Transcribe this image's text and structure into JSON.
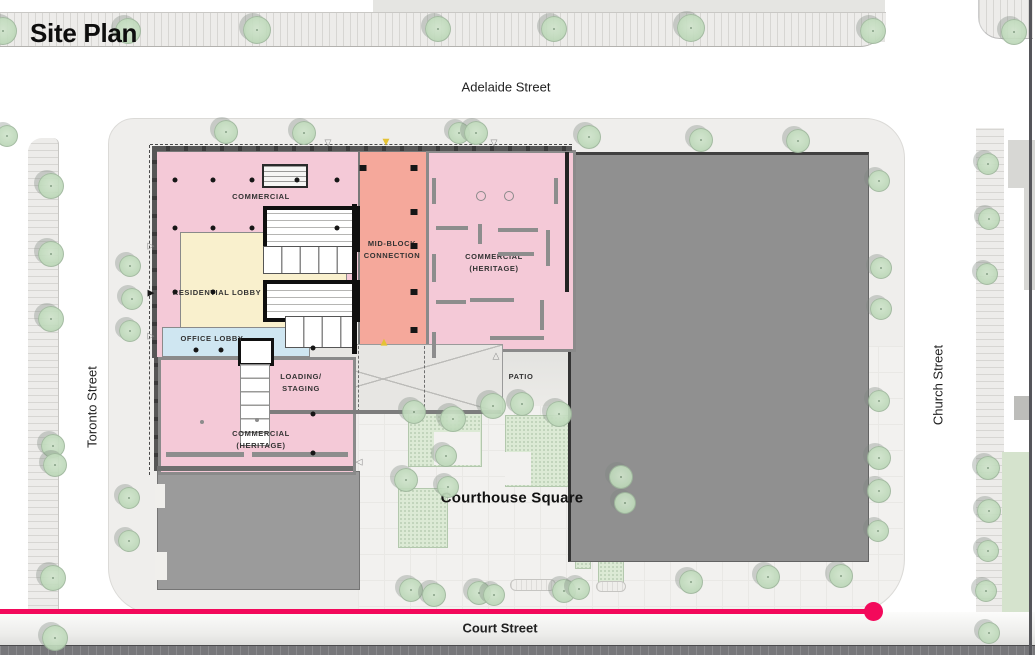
{
  "title": "Site Plan",
  "streets": {
    "top": "Adelaide Street",
    "left": "Toronto Street",
    "right": "Church Street",
    "bottom": "Court Street"
  },
  "plan_labels": {
    "commercial": "COMMERCIAL",
    "midblock_1": "MID-BLOCK",
    "midblock_2": "CONNECTION",
    "heritage_ne_1": "COMMERCIAL",
    "heritage_ne_2": "(HERITAGE)",
    "residential_lobby": "RESIDENTIAL LOBBY",
    "office_lobby": "OFFICE LOBBY",
    "loading_1": "LOADING/",
    "loading_2": "STAGING",
    "patio": "PATIO",
    "heritage_s_1": "COMMERCIAL",
    "heritage_s_2": "(HERITAGE)",
    "courthouse_square": "Courthouse Square"
  },
  "colors": {
    "commercial_pink": "#f4c9d7",
    "midblock_salmon": "#f5a89b",
    "residential_yellow": "#f9f0cd",
    "office_blue": "#cfe6f1",
    "existing_building_gray": "#909090",
    "tree_green": "#bed9ba",
    "planting_green": "#dcead5",
    "sidewalk_gray": "#edecea",
    "progress_red": "#f3095b"
  },
  "icons": {
    "open_down": "▽",
    "filled_down": "▼",
    "open_up": "△",
    "filled_up": "▲",
    "open_right": "▷",
    "filled_right": "▶",
    "open_left": "◁"
  },
  "map": {
    "trees": [
      [
        2,
        30,
        13
      ],
      [
        127,
        30,
        12
      ],
      [
        256,
        29,
        13
      ],
      [
        437,
        28,
        12
      ],
      [
        553,
        28,
        12
      ],
      [
        690,
        27,
        13
      ],
      [
        872,
        30,
        12
      ],
      [
        1013,
        31,
        12
      ],
      [
        225,
        131,
        11
      ],
      [
        303,
        132,
        11
      ],
      [
        458,
        132,
        10
      ],
      [
        475,
        132,
        11
      ],
      [
        588,
        136,
        11
      ],
      [
        700,
        139,
        11
      ],
      [
        797,
        140,
        11
      ],
      [
        6,
        135,
        10
      ],
      [
        50,
        185,
        12
      ],
      [
        50,
        253,
        12
      ],
      [
        50,
        318,
        12
      ],
      [
        52,
        445,
        11
      ],
      [
        54,
        464,
        11
      ],
      [
        52,
        577,
        12
      ],
      [
        54,
        637,
        12
      ],
      [
        129,
        265,
        10
      ],
      [
        131,
        298,
        10
      ],
      [
        129,
        330,
        10
      ],
      [
        128,
        497,
        10
      ],
      [
        128,
        540,
        10
      ],
      [
        413,
        411,
        11
      ],
      [
        452,
        418,
        12
      ],
      [
        492,
        405,
        12
      ],
      [
        521,
        403,
        11
      ],
      [
        558,
        413,
        12
      ],
      [
        445,
        455,
        10
      ],
      [
        405,
        479,
        11
      ],
      [
        447,
        486,
        10
      ],
      [
        620,
        476,
        11
      ],
      [
        624,
        502,
        10
      ],
      [
        410,
        589,
        11
      ],
      [
        433,
        594,
        11
      ],
      [
        478,
        592,
        11
      ],
      [
        493,
        594,
        10
      ],
      [
        563,
        590,
        11
      ],
      [
        578,
        588,
        10
      ],
      [
        690,
        581,
        11
      ],
      [
        767,
        576,
        11
      ],
      [
        840,
        575,
        11
      ],
      [
        878,
        180,
        10
      ],
      [
        880,
        267,
        10
      ],
      [
        880,
        308,
        10
      ],
      [
        878,
        400,
        10
      ],
      [
        878,
        457,
        11
      ],
      [
        878,
        490,
        11
      ],
      [
        877,
        530,
        10
      ],
      [
        987,
        163,
        10
      ],
      [
        988,
        218,
        10
      ],
      [
        986,
        273,
        10
      ],
      [
        987,
        467,
        11
      ],
      [
        988,
        510,
        11
      ],
      [
        987,
        550,
        10
      ],
      [
        985,
        590,
        10
      ],
      [
        988,
        632,
        10
      ]
    ],
    "column_dots": [
      [
        175,
        180
      ],
      [
        213,
        180
      ],
      [
        252,
        180
      ],
      [
        297,
        180
      ],
      [
        337,
        180
      ],
      [
        175,
        228
      ],
      [
        213,
        228
      ],
      [
        252,
        228
      ],
      [
        337,
        228
      ],
      [
        175,
        292
      ],
      [
        213,
        292
      ],
      [
        196,
        350
      ],
      [
        221,
        350
      ],
      [
        313,
        348
      ],
      [
        313,
        414
      ],
      [
        313,
        453
      ]
    ],
    "column_dots_light": [
      [
        202,
        422
      ],
      [
        257,
        420
      ]
    ],
    "column_squares": [
      [
        414,
        168
      ],
      [
        414,
        212
      ],
      [
        414,
        246
      ],
      [
        414,
        292
      ],
      [
        414,
        330
      ],
      [
        363,
        168
      ]
    ],
    "wall_segments": [
      [
        432,
        178,
        4,
        26
      ],
      [
        554,
        178,
        4,
        26
      ],
      [
        436,
        226,
        32,
        4
      ],
      [
        478,
        224,
        4,
        20
      ],
      [
        498,
        228,
        40,
        4
      ],
      [
        546,
        230,
        4,
        36
      ],
      [
        432,
        254,
        4,
        28
      ],
      [
        498,
        252,
        36,
        4
      ],
      [
        470,
        298,
        44,
        4
      ],
      [
        436,
        300,
        30,
        4
      ],
      [
        540,
        300,
        4,
        30
      ],
      [
        432,
        332,
        4,
        26
      ],
      [
        490,
        336,
        54,
        4
      ],
      [
        166,
        452,
        78,
        5
      ],
      [
        252,
        452,
        96,
        5
      ]
    ],
    "heritage_columns": [
      [
        481,
        196
      ],
      [
        509,
        196
      ]
    ],
    "entrance_markers": [
      [
        328,
        144,
        "open_down",
        "#8a8a8a"
      ],
      [
        386,
        143,
        "filled_down",
        "#e4c235"
      ],
      [
        494,
        144,
        "open_down",
        "#8a8a8a"
      ],
      [
        496,
        357,
        "open_up",
        "#8a8a8a"
      ],
      [
        384,
        343,
        "filled_up",
        "#e4c235"
      ],
      [
        151,
        247,
        "open_right",
        "#8a8a8a"
      ],
      [
        151,
        294,
        "filled_right",
        "#151515"
      ],
      [
        151,
        337,
        "open_right",
        "#8a8a8a"
      ],
      [
        359,
        463,
        "open_left",
        "#8a8a8a"
      ]
    ]
  },
  "timeline": {
    "progress_percent": 84.4
  }
}
